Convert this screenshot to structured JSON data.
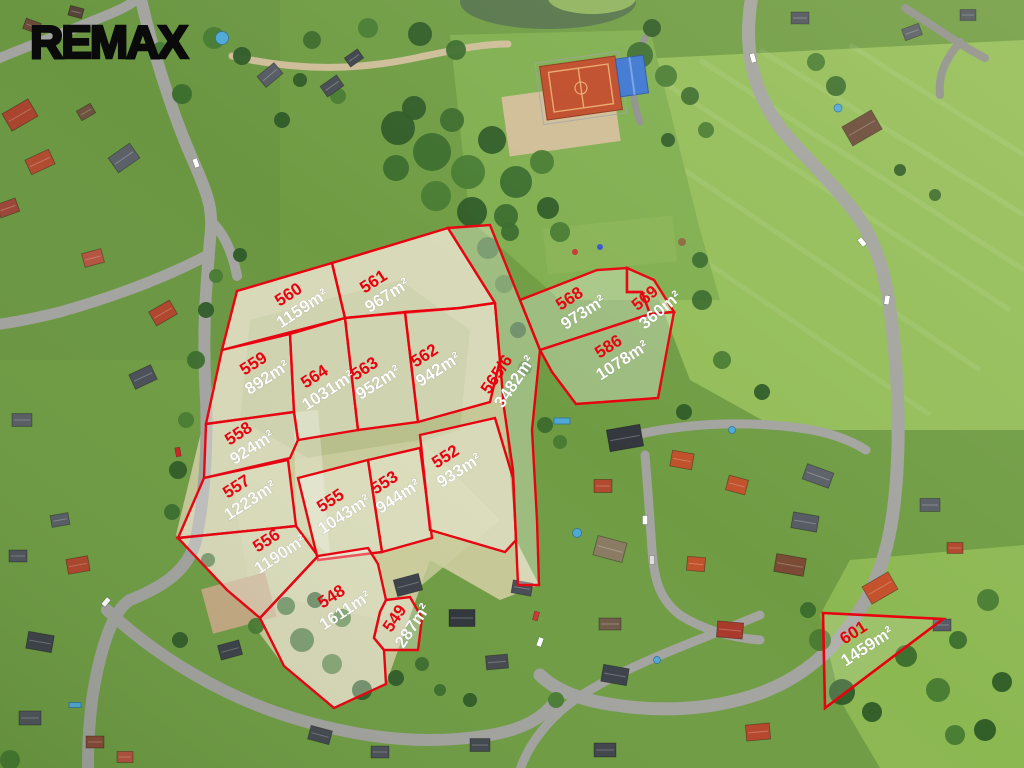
{
  "watermark": {
    "brand": "REMAX"
  },
  "overlay": {
    "line_color": "#e8000d",
    "number_color": "#e8000d",
    "area_color": "#ffffff"
  },
  "parcels": [
    {
      "number": "560",
      "area": "1159m²"
    },
    {
      "number": "561",
      "area": "967m²"
    },
    {
      "number": "559",
      "area": "892m²"
    },
    {
      "number": "564",
      "area": "1031m²"
    },
    {
      "number": "563",
      "area": "952m²"
    },
    {
      "number": "562",
      "area": "942m²"
    },
    {
      "number": "558",
      "area": "924m²"
    },
    {
      "number": "557",
      "area": "1223m²"
    },
    {
      "number": "556",
      "area": "1190m²"
    },
    {
      "number": "555",
      "area": "1043m²"
    },
    {
      "number": "553",
      "area": "944m²"
    },
    {
      "number": "552",
      "area": "933m²"
    },
    {
      "number": "548",
      "area": "1611m²"
    },
    {
      "number": "549",
      "area": "287m²"
    },
    {
      "number": "565/6",
      "area": "3482m²"
    },
    {
      "number": "568",
      "area": "973m²"
    },
    {
      "number": "569",
      "area": "360m²"
    },
    {
      "number": "586",
      "area": "1078m²"
    },
    {
      "number": "601",
      "area": "1459m²"
    }
  ]
}
